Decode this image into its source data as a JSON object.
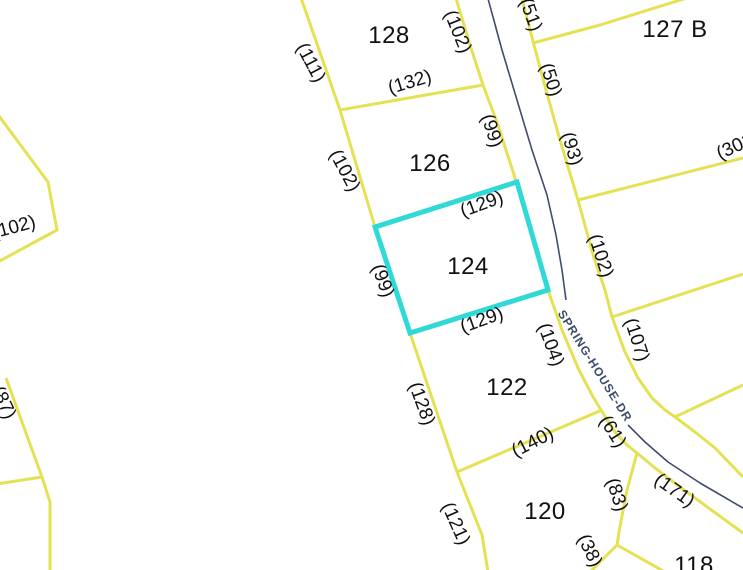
{
  "map": {
    "road": {
      "name": "SPRING-HOUSE-DR"
    },
    "selected_parcel_id": "124",
    "colors": {
      "background": "#ffffff",
      "parcel_boundary": "#e4e153",
      "selected_outline": "#2ed9d6",
      "road_centerline": "#3f4c6e",
      "label_text": "#111111",
      "road_label_text": "#3d4a6b"
    },
    "parcel_labels": [
      {
        "id": "128",
        "text": "128",
        "x": 389,
        "y": 36
      },
      {
        "id": "126",
        "text": "126",
        "x": 430,
        "y": 164
      },
      {
        "id": "124",
        "text": "124",
        "x": 468,
        "y": 267
      },
      {
        "id": "122",
        "text": "122",
        "x": 507,
        "y": 388
      },
      {
        "id": "120",
        "text": "120",
        "x": 545,
        "y": 512
      },
      {
        "id": "118",
        "text": "118",
        "x": 694,
        "y": 566
      },
      {
        "id": "127-B",
        "text": "127 B",
        "x": 675,
        "y": 30
      }
    ],
    "dimension_labels": [
      {
        "text": "(111)",
        "x": 310,
        "y": 63,
        "rot": 62
      },
      {
        "text": "(102)",
        "x": 344,
        "y": 171,
        "rot": 62
      },
      {
        "text": "(99)",
        "x": 382,
        "y": 281,
        "rot": 70
      },
      {
        "text": "(128)",
        "x": 421,
        "y": 404,
        "rot": 70
      },
      {
        "text": "(121)",
        "x": 455,
        "y": 524,
        "rot": 66
      },
      {
        "text": "(87)",
        "x": 3,
        "y": 403,
        "rot": 65
      },
      {
        "text": "(102)",
        "x": 14,
        "y": 228,
        "rot": -15
      },
      {
        "text": "(132)",
        "x": 410,
        "y": 83,
        "rot": -17
      },
      {
        "text": "(129)",
        "x": 482,
        "y": 205,
        "rot": -20
      },
      {
        "text": "(129)",
        "x": 482,
        "y": 321,
        "rot": -20
      },
      {
        "text": "(140)",
        "x": 533,
        "y": 443,
        "rot": -27
      },
      {
        "text": "(102)",
        "x": 457,
        "y": 32,
        "rot": 68
      },
      {
        "text": "(99)",
        "x": 491,
        "y": 131,
        "rot": 72
      },
      {
        "text": "(51)",
        "x": 530,
        "y": 15,
        "rot": 70
      },
      {
        "text": "(50)",
        "x": 550,
        "y": 80,
        "rot": 72
      },
      {
        "text": "(93)",
        "x": 571,
        "y": 149,
        "rot": 74
      },
      {
        "text": "(102)",
        "x": 600,
        "y": 256,
        "rot": 72
      },
      {
        "text": "(107)",
        "x": 636,
        "y": 340,
        "rot": 72
      },
      {
        "text": "(104)",
        "x": 550,
        "y": 345,
        "rot": 70
      },
      {
        "text": "(61)",
        "x": 612,
        "y": 432,
        "rot": 58
      },
      {
        "text": "(83)",
        "x": 616,
        "y": 495,
        "rot": 72
      },
      {
        "text": "(38)",
        "x": 589,
        "y": 551,
        "rot": 64
      },
      {
        "text": "(171)",
        "x": 674,
        "y": 491,
        "rot": 35
      },
      {
        "text": "(301)",
        "x": 738,
        "y": 146,
        "rot": -25
      }
    ],
    "road_label": {
      "x": 595,
      "y": 366,
      "rot": 58
    }
  }
}
